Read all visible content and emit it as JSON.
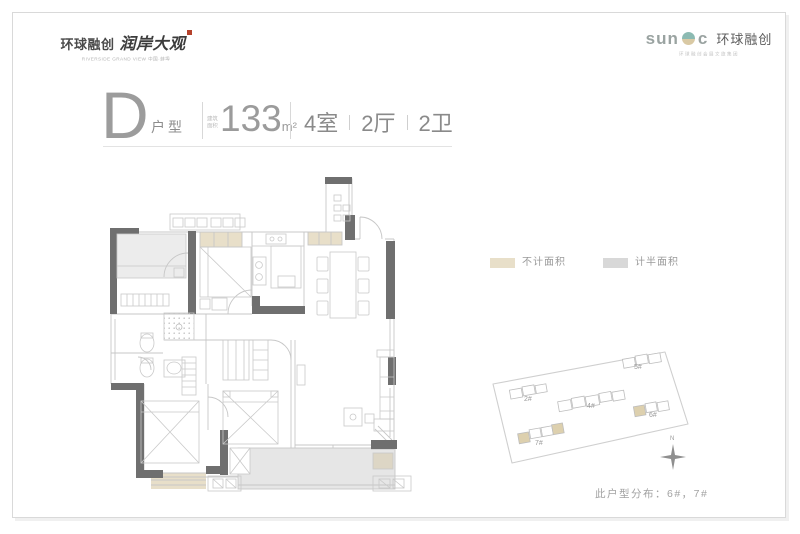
{
  "header": {
    "left_logo": {
      "brand": "环球融创",
      "project": "润岸大观",
      "subtitle": "RIVERSIDE GRAND VIEW 中国·蚌埠"
    },
    "right_logo": {
      "word_pre": "sun",
      "word_post": "c",
      "brand_cn": "环球融创",
      "tagline": "环球融创会展文旅集团"
    }
  },
  "title": {
    "plan_letter": "D",
    "plan_type": "户型",
    "area_label_line1": "建筑",
    "area_label_line2": "面积",
    "area_value": "133",
    "area_unit": "m²",
    "room_specs": [
      "4室",
      "2厅",
      "2卫"
    ]
  },
  "legend": {
    "items": [
      {
        "label": "不计面积",
        "color": "#e8dfc9"
      },
      {
        "label": "计半面积",
        "color": "#d8d8d8"
      }
    ]
  },
  "site_plan": {
    "buildings": [
      {
        "id": "2#",
        "highlighted": false
      },
      {
        "id": "4#",
        "highlighted": false
      },
      {
        "id": "5#",
        "highlighted": false
      },
      {
        "id": "6#",
        "highlighted": true
      },
      {
        "id": "7#",
        "highlighted": true
      }
    ],
    "compass_label": "N",
    "caption": "此户型分布：6#，7#"
  },
  "floor_plan": {
    "colors": {
      "wall": "#6f6f6f",
      "line": "#c7c7c7",
      "excluded_area_fill": "#e8dfc9",
      "half_area_fill": "#e6e6e6",
      "room_shade_fill": "#ececec"
    }
  }
}
